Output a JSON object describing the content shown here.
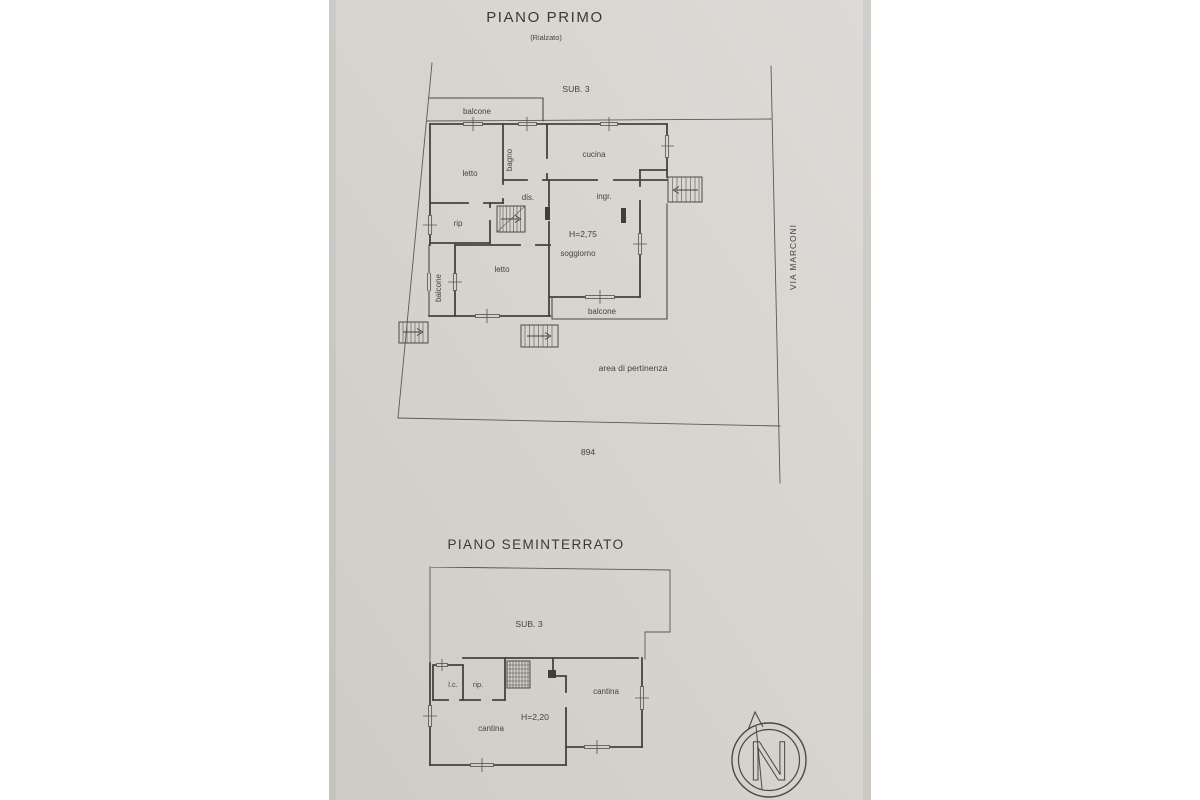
{
  "document": {
    "floor1": {
      "title": "PIANO PRIMO",
      "subtitle": "(Rialzato)",
      "sub_label": "SUB. 3",
      "rooms": {
        "balcone_top": "balcone",
        "letto_1": "letto",
        "bagno": "bagno",
        "cucina": "cucina",
        "dis": "dis.",
        "ingr": "ingr.",
        "rip": "rip",
        "height": "H=2,75",
        "soggiorno": "soggiorno",
        "balcone_left": "balcone",
        "letto_2": "letto",
        "balcone_bottom": "balcone"
      },
      "area_label": "area di pertinenza",
      "street_label": "VIA MARCONI",
      "parcel_number": "894"
    },
    "floor0": {
      "title": "PIANO SEMINTERRATO",
      "sub_label": "SUB. 3",
      "rooms": {
        "lc": "l.c.",
        "rip": "rip.",
        "cantina_right": "cantina",
        "height": "H=2,20",
        "cantina_left": "cantina"
      }
    },
    "compass": {
      "north_letter": "N"
    },
    "colors": {
      "paper": "#d7d4cf",
      "ink": "#45433e"
    }
  }
}
